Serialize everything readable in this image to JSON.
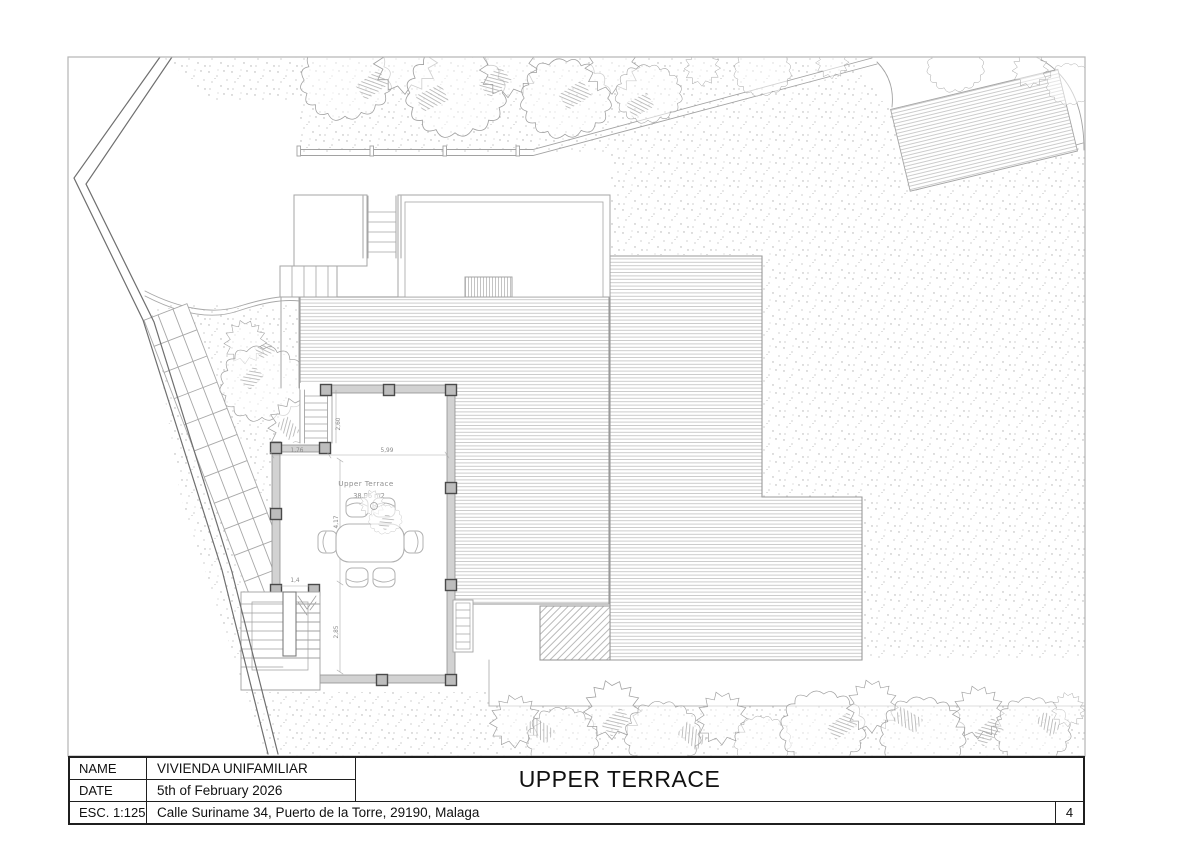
{
  "title_block": {
    "name_label": "NAME",
    "name_value": "VIVIENDA UNIFAMILIAR",
    "date_label": "DATE",
    "date_value": "5th of February 2026",
    "scale_label": "ESC. 1:125",
    "address": "Calle Suriname 34, Puerto de la Torre, 29190, Malaga",
    "sheet_title": "UPPER TERRACE",
    "page_number": "4"
  },
  "plan": {
    "room_label": "Upper Terrace",
    "room_area": "38,96 m2",
    "dimensions": {
      "top_width": "5,99",
      "step_width": "1,76",
      "upper_stair_height": "2,60",
      "room_height": "4,17",
      "stair_opening": "1,4",
      "lower_height": "2,85"
    }
  },
  "colors": {
    "line": "#9c9c9c",
    "boundary": "#6f6f6f",
    "wall_fill": "#d2d2d2",
    "column_fill": "#bdbdbd",
    "column_stroke": "#4a4a4a",
    "drawing_text": "#8a8a8a",
    "frame": "#b5b5b5",
    "title_border": "#1f1f1f"
  }
}
